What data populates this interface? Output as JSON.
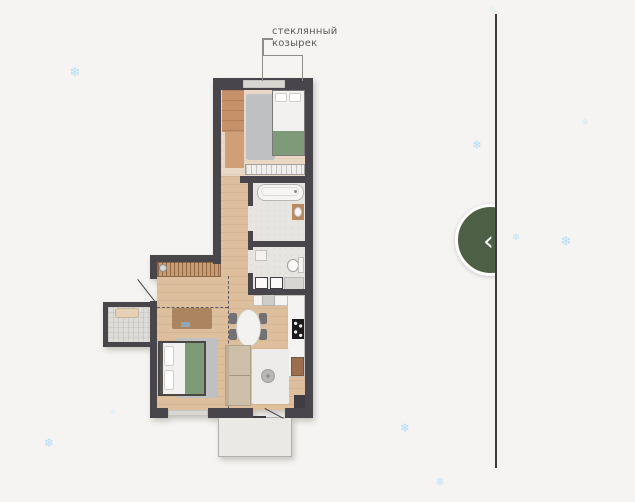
{
  "page": {
    "background_color": "#f5f4f2"
  },
  "carousel": {
    "prev_icon": "‹",
    "button_color": "#4d6046",
    "divider_color": "#3b3b3b"
  },
  "floorplan": {
    "annotation_line1": "стеклянный",
    "annotation_line2": "козырек",
    "wall_color": "#48464a",
    "accent_green": "#7f9a79",
    "rooms": [
      "bedroom",
      "hallway",
      "bathroom",
      "wc",
      "living-room",
      "kitchen",
      "bedroom-2",
      "balcony",
      "terrace"
    ]
  },
  "snowflakes": {
    "glyph": "❄",
    "color": "#a9dcf6",
    "items": [
      {
        "x": 75,
        "y": 73,
        "size": 13,
        "opacity": 0.85
      },
      {
        "x": 477,
        "y": 145,
        "size": 12,
        "opacity": 0.9
      },
      {
        "x": 585,
        "y": 123,
        "size": 9,
        "opacity": 0.4
      },
      {
        "x": 516,
        "y": 238,
        "size": 10,
        "opacity": 0.65
      },
      {
        "x": 566,
        "y": 242,
        "size": 13,
        "opacity": 0.9
      },
      {
        "x": 405,
        "y": 428,
        "size": 12,
        "opacity": 0.85
      },
      {
        "x": 440,
        "y": 482,
        "size": 11,
        "opacity": 0.7
      },
      {
        "x": 49,
        "y": 443,
        "size": 12,
        "opacity": 0.9
      },
      {
        "x": 113,
        "y": 412,
        "size": 8,
        "opacity": 0.35
      },
      {
        "x": 492,
        "y": 10,
        "size": 10,
        "opacity": 0.2
      }
    ]
  }
}
